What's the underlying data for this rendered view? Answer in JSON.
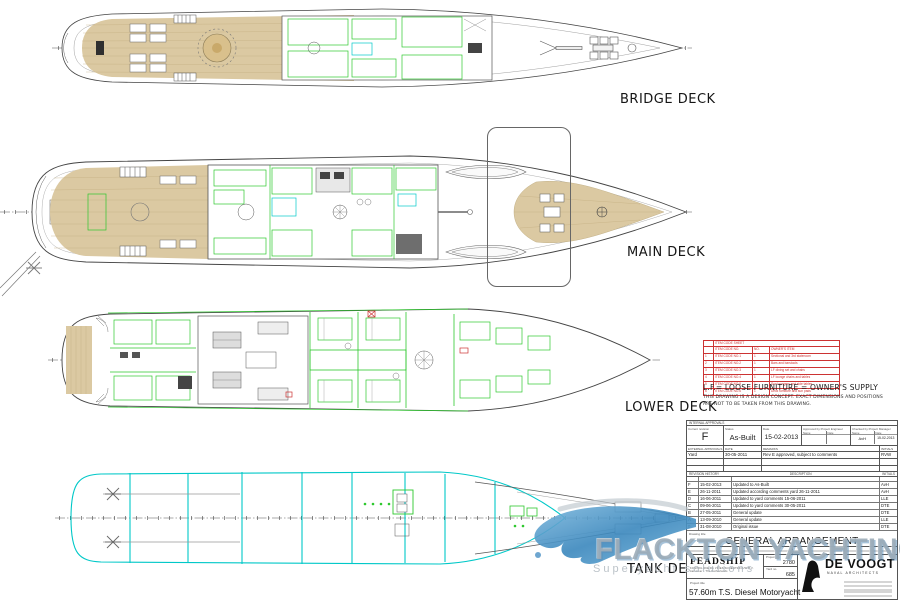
{
  "colors": {
    "furniture_green": "#2ec82e",
    "tankdeck_cyan": "#00c8c8",
    "teak": "#dbc9a2",
    "item_table_red": "#cc3333",
    "watermark_blue": "#4a90c4",
    "watermark_gray": "#9aaab6"
  },
  "decks": [
    {
      "label": "BRIDGE DECK"
    },
    {
      "label": "MAIN DECK"
    },
    {
      "label": "LOWER DECK"
    },
    {
      "label": "TANK DECK"
    }
  ],
  "notes": {
    "loose_furniture": "L.F.= LOOSE FURNITURE = OWNER'S SUPPLY",
    "concept_line1": "THIS DRAWING IS A DESIGN CONCEPT. EXACT DIMENSIONS AND POSITIONS",
    "concept_line2": "ARE NOT TO BE TAKEN FROM THIS DRAWING."
  },
  "item_table": {
    "title": "ITEM CODE SHEET",
    "col_item": "ITEM CODE NO.",
    "col_qty": "NO.",
    "col_desc": "OWNER'S ITEM",
    "rows": [
      {
        "n": "1",
        "code": "ITEM CODE NO.1",
        "qty": "1",
        "desc": "Sectional and 3rd stateroom"
      },
      {
        "n": "2",
        "code": "ITEM CODE NO.2",
        "qty": "1",
        "desc": "Bars and barstools"
      },
      {
        "n": "3",
        "code": "ITEM CODE NO.3",
        "qty": "1",
        "desc": "LF dining set and chairs"
      },
      {
        "n": "4",
        "code": "ITEM CODE NO.4",
        "qty": "1",
        "desc": "LF lounge chairs and tables"
      },
      {
        "n": "5",
        "code": "ITEM CODE NO.5",
        "qty": "1",
        "desc": "Sun loungers and side tables"
      },
      {
        "n": "6",
        "code": "ITEM CODE NO.6",
        "qty": "1",
        "desc": "Deck furniture and sun pads"
      }
    ]
  },
  "title_block": {
    "internal_header": "INTERNAL APPROVALS",
    "labels": {
      "current_revision": "Current revision",
      "status": "Status",
      "date": "Date",
      "approved": "Approved by Project Engineer",
      "checked": "Checked by Project Manager",
      "name": "Name",
      "date_s": "Date",
      "external": "EXTERNAL APPROVALS",
      "ext_date": "DATE",
      "remarks": "REMARKS",
      "initials": "INITIALS",
      "revision_history": "REVISION HISTORY",
      "description": "DESCRIPTION",
      "drawing_title": "Drawing title",
      "project_title": "Project title",
      "project_no": "Project no.",
      "yard_no": "Yard no."
    },
    "values": {
      "current_revision": "F",
      "status": "As-Built",
      "date": "15-02-2013",
      "checked_name": "AvH",
      "checked_date": "15-02-2013"
    },
    "external_row": {
      "party": "Yard",
      "date": "30-05-2011",
      "remarks": "Rev E approved, subject to comments",
      "initials": "RVW"
    },
    "revisions": [
      {
        "rev": "F",
        "date": "15-02-2013",
        "description": "Updated to As-Built",
        "initials": "AvH"
      },
      {
        "rev": "E",
        "date": "26-11-2011",
        "description": "Updated according comments yard 26-11-2011",
        "initials": "AvH"
      },
      {
        "rev": "D",
        "date": "16-06-2011",
        "description": "Updated to yard comments 15-06-2011",
        "initials": "LLE"
      },
      {
        "rev": "C",
        "date": "09-06-2011",
        "description": "Updated to yard comments 30-05-2011",
        "initials": "DTE"
      },
      {
        "rev": "B",
        "date": "27-05-2011",
        "description": "General update",
        "initials": "DTE"
      },
      {
        "rev": "A",
        "date": "13-09-2010",
        "description": "General update",
        "initials": "LLE"
      },
      {
        "rev": "0",
        "date": "31-08-2010",
        "description": "Original issue",
        "initials": "DTE"
      }
    ],
    "drawing_title": "GENERAL ARRANGEMENT",
    "builder": {
      "logo": "FEADSHIP",
      "line1": "KONINKLIJKE DE VRIES SCHEEPSBOUW B.V.",
      "line2": "Aalsmeer - The Netherlands",
      "project_no": "2780",
      "yard_no": "685",
      "project_title": "57.60m T.S. Diesel Motoryacht"
    },
    "architect": {
      "name": "DE VOOGT",
      "subtitle": "NAVAL ARCHITECTS"
    }
  },
  "watermark": {
    "line1": "FLACKTON YACHTING",
    "line2": "Superyacht solutions"
  }
}
